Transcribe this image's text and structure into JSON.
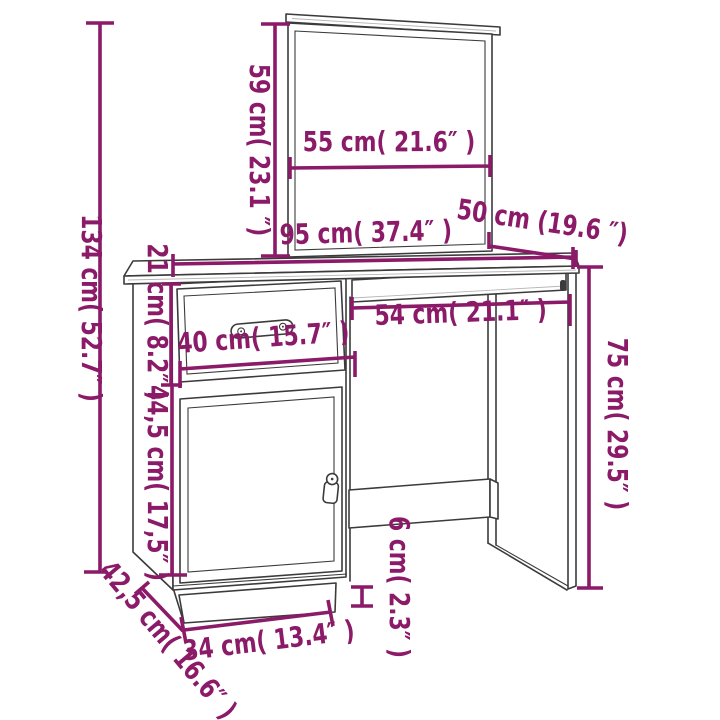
{
  "diagram": {
    "type": "product-dimension-diagram",
    "subject": "dressing-table-with-mirror",
    "colors": {
      "dimension": "#8B1A68",
      "furniture_line": "#3B3B3B",
      "shading": "#B5B5B5",
      "background": "#FFFFFF"
    },
    "dimensions": {
      "total_height": {
        "label": "134 cm( 52.7″ )"
      },
      "mirror_height": {
        "label": "59 cm( 23.1 ″)"
      },
      "mirror_width": {
        "label": "55 cm( 21.6″ )"
      },
      "desk_width": {
        "label": "95 cm( 37.4″ )"
      },
      "desk_depth": {
        "label": "50 cm (19.6 ″)"
      },
      "drawer_height": {
        "label": "21 cm( 8.2″ )"
      },
      "drawer_width": {
        "label": "40 cm( 15.7″ )"
      },
      "knee_width": {
        "label": "54 cm( 21.1″ )"
      },
      "knee_height": {
        "label": "75 cm( 29.5″ )"
      },
      "door_height": {
        "label": "44,5 cm( 17,5″ )"
      },
      "base_depth": {
        "label": "42,5 cm( 16.6″ )"
      },
      "base_width": {
        "label": "34 cm( 13.4″ )"
      },
      "plinth_height": {
        "label": "6 cm( 2.3″ )"
      }
    }
  }
}
